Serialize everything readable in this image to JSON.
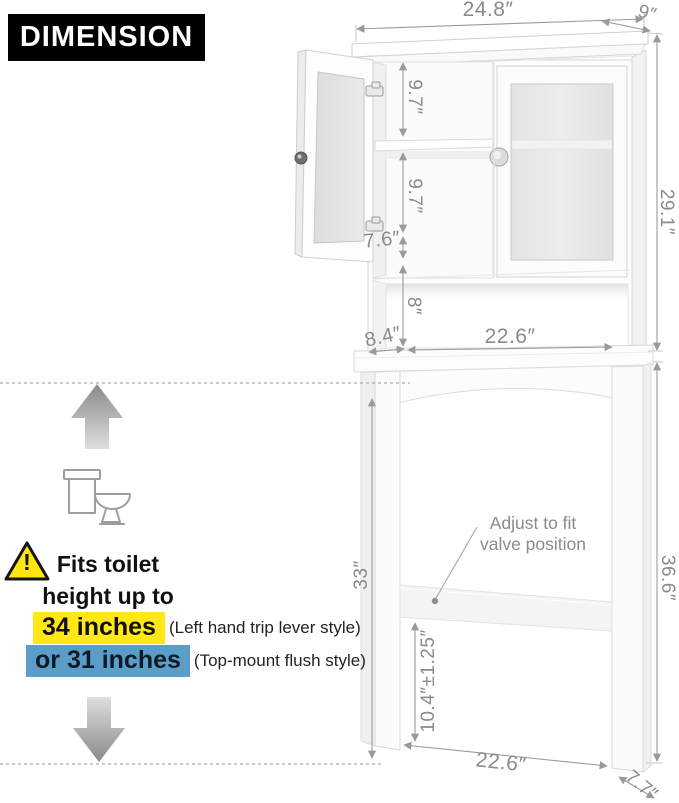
{
  "header": {
    "title": "DIMENSION"
  },
  "dims": {
    "top_width": "24.8″",
    "top_depth": "9″",
    "cabinet_height": "29.1″",
    "shelf_upper": "9.7″",
    "shelf_lower": "9.7″",
    "door_gap": "7.6″",
    "cubby_height": "8″",
    "cubby_depth": "8.4″",
    "cubby_width": "22.6″",
    "leg_height": "33″",
    "frame_height": "36.6″",
    "valve_range": "10.4″±1.25″",
    "base_width": "22.6″",
    "base_depth": "7.7″"
  },
  "annotations": {
    "valve_line1": "Adjust to fit",
    "valve_line2": "valve position"
  },
  "fit_info": {
    "warning_mark": "!",
    "line1": "Fits toilet",
    "line2": "height up to",
    "option1": "34 inches",
    "option1_note": "(Left hand trip lever style)",
    "option2": "or 31 inches",
    "option2_note": "(Top-mount flush style)"
  },
  "colors": {
    "option1_highlight": "#ffe815",
    "option2_highlight": "#5b9dc7",
    "dimension_text": "#8b8b8b",
    "header_bg": "#000000"
  },
  "icons": {
    "up_arrow": "up-arrow-icon",
    "down_arrow": "down-arrow-icon",
    "toilet": "toilet-icon",
    "warning": "warning-triangle-icon"
  }
}
